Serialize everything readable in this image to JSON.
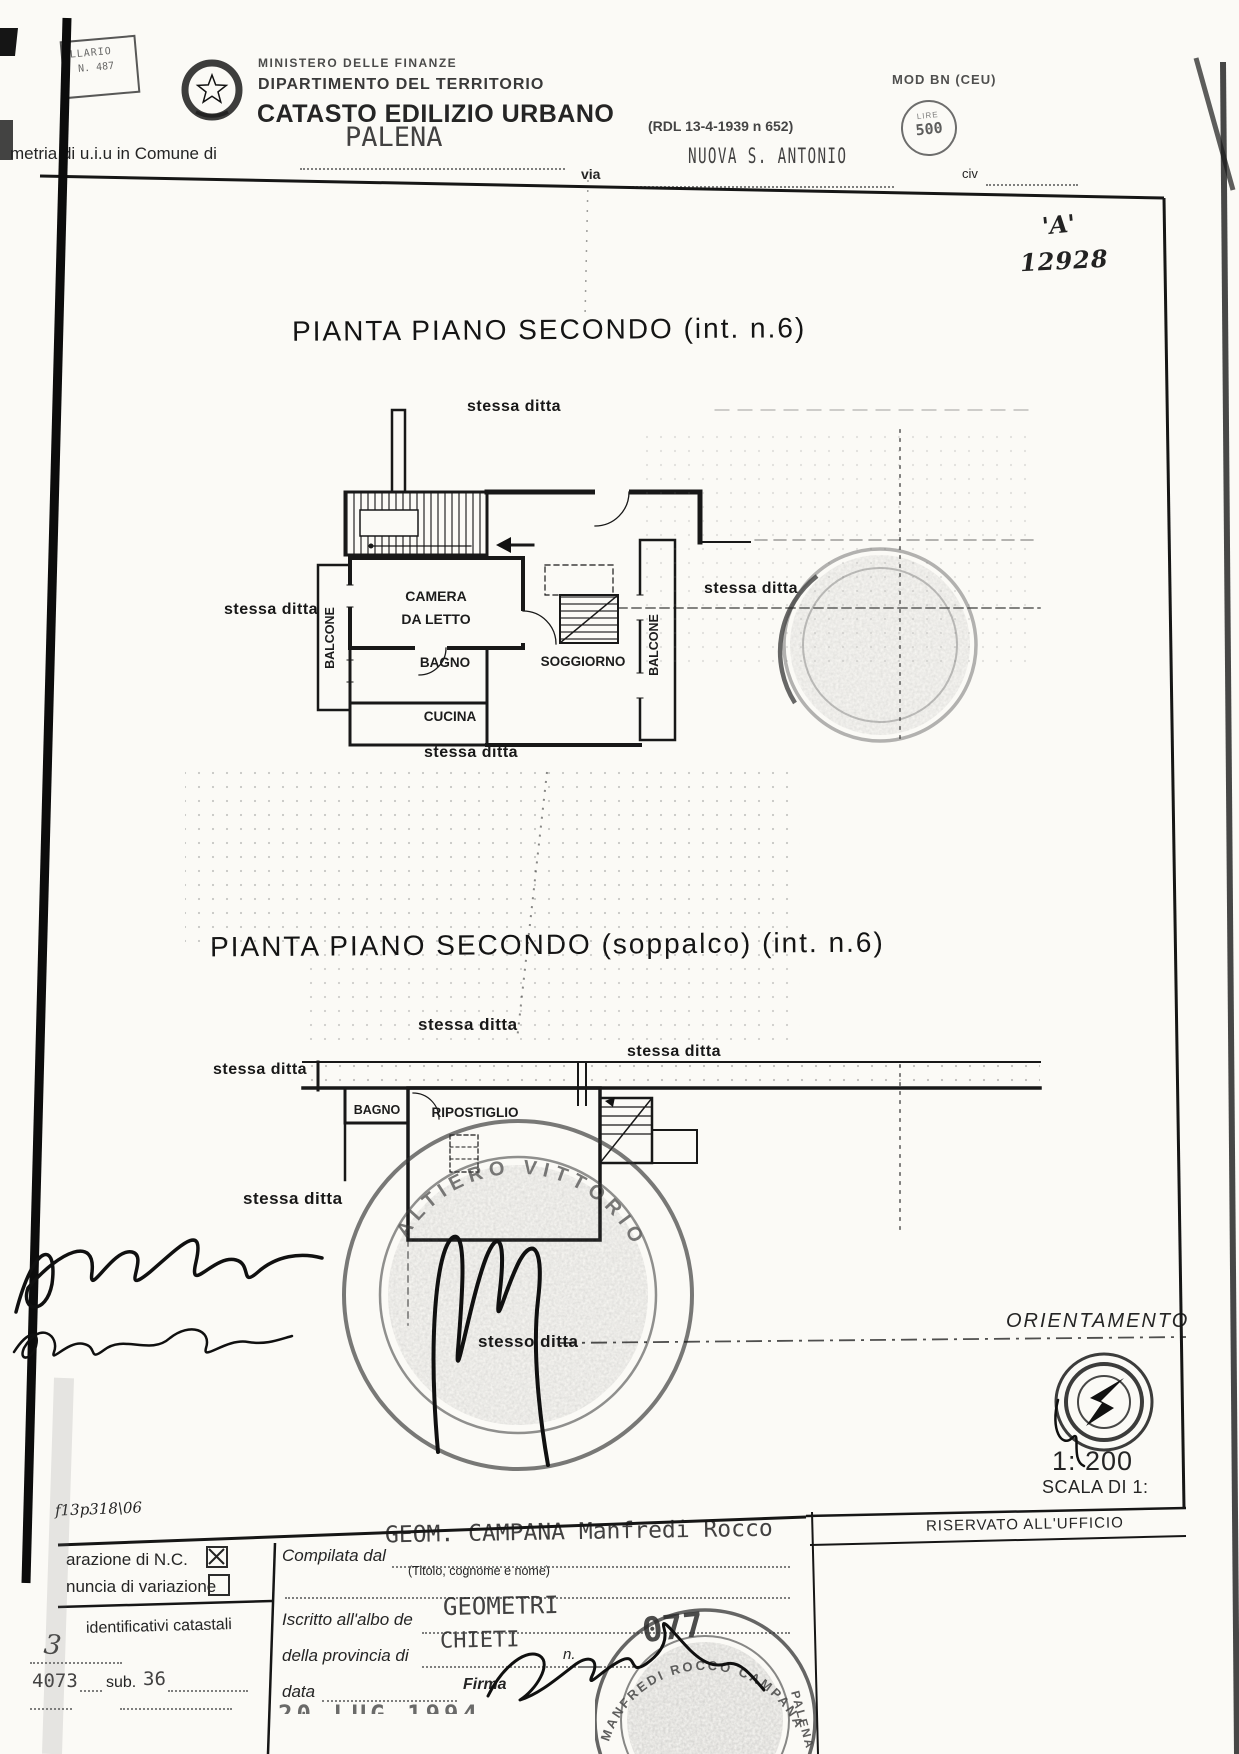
{
  "labels": {
    "stessa_ditta": "stessa ditta",
    "stesso_ditta": "stesso ditta"
  },
  "header": {
    "stamp_box_line1": "LLARIO",
    "stamp_box_line2": "N. 487",
    "ministry_line1": "MINISTERO DELLE FINANZE",
    "ministry_line2": "DIPARTIMENTO DEL TERRITORIO",
    "title": "CATASTO EDILIZIO URBANO",
    "law_ref": "(RDL 13-4-1939 n 652)",
    "mod_label": "MOD BN (CEU)",
    "bollo_top": "LIRE",
    "bollo_value": "500",
    "comune_label": "metria di u.i.u  in Comune di",
    "comune_value": "PALENA",
    "via_label": "via",
    "via_value": "NUOVA S. ANTONIO",
    "civ_label": "civ"
  },
  "annotations": {
    "letter": "'A'",
    "number": "12928",
    "footer_note": "f13p318\\06"
  },
  "plan1": {
    "title": "PIANTA PIANO SECONDO (int. n.6)",
    "rooms": {
      "balcone_left": "BALCONE",
      "camera_line1": "CAMERA",
      "camera_line2": "DA LETTO",
      "bagno": "BAGNO",
      "cucina": "CUCINA",
      "soggiorno": "SOGGIORNO",
      "balcone_right": "BALCONE"
    }
  },
  "plan2": {
    "title": "PIANTA PIANO SECONDO (soppalco) (int. n.6)",
    "rooms": {
      "bagno": "BAGNO",
      "ripostiglio": "RIPOSTIGLIO"
    }
  },
  "stamps": {
    "stamp2_arc": "ALTIERO VITTORIO",
    "stamp3_arc": "MANFREDI ROCCO CAMPANA",
    "stamp3_side": "PALENA"
  },
  "orientation": {
    "title": "ORIENTAMENTO",
    "scale_value": "1: 200",
    "scale_label": "SCALA DI 1:"
  },
  "form": {
    "left": {
      "row1_label": "arazione di N.C.",
      "row1_checked": true,
      "row2_label": "nuncia di  variazione",
      "row2_checked": false,
      "identificativi_label": "identificativi catastali",
      "handwritten_foglio": "3",
      "particella_value": "4073",
      "sub_label": "sub.",
      "sub_value": "36"
    },
    "middle": {
      "compilata_label": "Compilata dal",
      "compilata_value": "GEOM. CAMPANA Manfredi Rocco",
      "titolo_hint": "(Titolo, cognome e nome)",
      "iscritto_label": "Iscritto all'albo de",
      "albo_value": "GEOMETRI",
      "provincia_label": "della provincia di",
      "provincia_value": "CHIETI",
      "n_label": "n.",
      "n_value": "077",
      "data_label": "data",
      "firma_label": "Firma",
      "date_stamp": "20 LUG 1994"
    },
    "right": {
      "riservato_label": "RISERVATO ALL'UFFICIO"
    }
  }
}
